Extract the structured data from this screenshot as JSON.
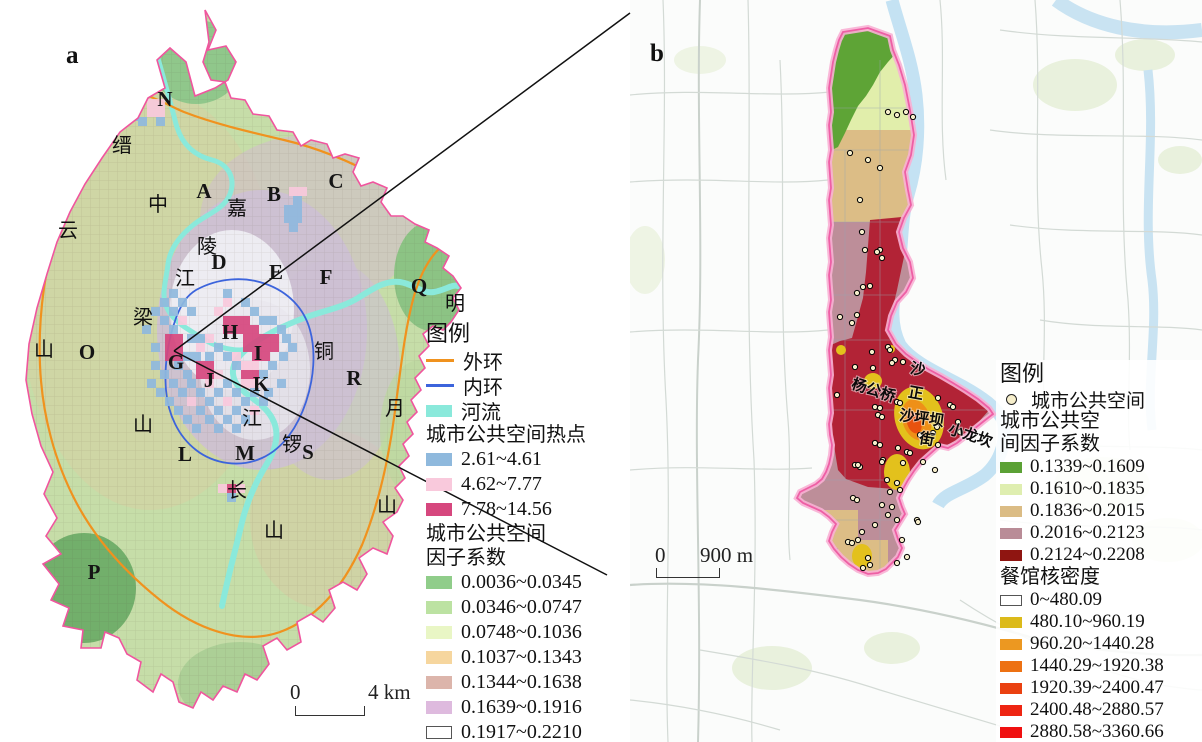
{
  "panel_a": {
    "label": "a",
    "scalebar": {
      "start": "0",
      "end": "4 km"
    },
    "letters": [
      {
        "t": "N",
        "x": 165,
        "y": 106
      },
      {
        "t": "A",
        "x": 204,
        "y": 198
      },
      {
        "t": "B",
        "x": 274,
        "y": 201
      },
      {
        "t": "C",
        "x": 336,
        "y": 188
      },
      {
        "t": "D",
        "x": 219,
        "y": 269
      },
      {
        "t": "E",
        "x": 276,
        "y": 279
      },
      {
        "t": "F",
        "x": 326,
        "y": 284
      },
      {
        "t": "Q",
        "x": 419,
        "y": 293
      },
      {
        "t": "G",
        "x": 176,
        "y": 369
      },
      {
        "t": "H",
        "x": 230,
        "y": 339
      },
      {
        "t": "I",
        "x": 258,
        "y": 360
      },
      {
        "t": "J",
        "x": 209,
        "y": 387
      },
      {
        "t": "K",
        "x": 261,
        "y": 391
      },
      {
        "t": "L",
        "x": 185,
        "y": 461
      },
      {
        "t": "M",
        "x": 245,
        "y": 460
      },
      {
        "t": "R",
        "x": 354,
        "y": 385
      },
      {
        "t": "S",
        "x": 308,
        "y": 459
      },
      {
        "t": "O",
        "x": 87,
        "y": 359
      },
      {
        "t": "P",
        "x": 94,
        "y": 579
      }
    ],
    "geo_labels": [
      {
        "t": "缙",
        "x": 122,
        "y": 152
      },
      {
        "t": "云",
        "x": 68,
        "y": 237
      },
      {
        "t": "山",
        "x": 44,
        "y": 356
      },
      {
        "t": "中",
        "x": 158,
        "y": 211
      },
      {
        "t": "梁",
        "x": 143,
        "y": 324
      },
      {
        "t": "山",
        "x": 143,
        "y": 431
      },
      {
        "t": "嘉",
        "x": 237,
        "y": 215
      },
      {
        "t": "陵",
        "x": 207,
        "y": 253
      },
      {
        "t": "江",
        "x": 185,
        "y": 285
      },
      {
        "t": "铜",
        "x": 324,
        "y": 358
      },
      {
        "t": "锣",
        "x": 292,
        "y": 451
      },
      {
        "t": "山",
        "x": 274,
        "y": 537
      },
      {
        "t": "明",
        "x": 455,
        "y": 310
      },
      {
        "t": "月",
        "x": 395,
        "y": 415
      },
      {
        "t": "山",
        "x": 387,
        "y": 512
      },
      {
        "t": "江",
        "x": 252,
        "y": 425
      },
      {
        "t": "长",
        "x": 237,
        "y": 497
      }
    ],
    "hotspot_cells": [
      [
        "p",
        147,
        99
      ],
      [
        "p",
        156,
        99
      ],
      [
        "p",
        147,
        108
      ],
      [
        "p",
        156,
        108
      ],
      [
        "b",
        129,
        112
      ],
      [
        "b",
        138,
        117
      ],
      [
        "b",
        156,
        117
      ],
      [
        "p",
        289,
        187
      ],
      [
        "p",
        298,
        187
      ],
      [
        "b",
        293,
        196
      ],
      [
        "b",
        284,
        205
      ],
      [
        "b",
        293,
        205
      ],
      [
        "b",
        284,
        214
      ],
      [
        "b",
        293,
        214
      ],
      [
        "b",
        289,
        223
      ],
      [
        "b",
        169,
        289
      ],
      [
        "b",
        223,
        289
      ],
      [
        "b",
        160,
        298
      ],
      [
        "b",
        178,
        298
      ],
      [
        "p",
        223,
        298
      ],
      [
        "b",
        241,
        298
      ],
      [
        "b",
        151,
        307
      ],
      [
        "b",
        169,
        307
      ],
      [
        "b",
        187,
        307
      ],
      [
        "p",
        214,
        307
      ],
      [
        "b",
        250,
        307
      ],
      [
        "b",
        160,
        316
      ],
      [
        "p",
        178,
        316
      ],
      [
        "m",
        223,
        316
      ],
      [
        "m",
        232,
        316
      ],
      [
        "m",
        241,
        316
      ],
      [
        "b",
        259,
        316
      ],
      [
        "b",
        268,
        316
      ],
      [
        "b",
        142,
        325
      ],
      [
        "b",
        169,
        325
      ],
      [
        "m",
        223,
        325
      ],
      [
        "m",
        232,
        325
      ],
      [
        "m",
        241,
        325
      ],
      [
        "m",
        250,
        325
      ],
      [
        "b",
        277,
        325
      ],
      [
        "m",
        165,
        334
      ],
      [
        "m",
        174,
        334
      ],
      [
        "b",
        187,
        334
      ],
      [
        "b",
        196,
        334
      ],
      [
        "p",
        205,
        334
      ],
      [
        "m",
        243,
        334
      ],
      [
        "m",
        252,
        334
      ],
      [
        "m",
        261,
        334
      ],
      [
        "m",
        270,
        334
      ],
      [
        "b",
        282,
        334
      ],
      [
        "m",
        165,
        343
      ],
      [
        "m",
        174,
        343
      ],
      [
        "b",
        151,
        343
      ],
      [
        "p",
        196,
        343
      ],
      [
        "b",
        214,
        343
      ],
      [
        "m",
        243,
        343
      ],
      [
        "m",
        252,
        343
      ],
      [
        "m",
        261,
        343
      ],
      [
        "m",
        270,
        343
      ],
      [
        "b",
        288,
        343
      ],
      [
        "m",
        165,
        352
      ],
      [
        "m",
        174,
        352
      ],
      [
        "b",
        183,
        352
      ],
      [
        "b",
        192,
        352
      ],
      [
        "b",
        205,
        352
      ],
      [
        "b",
        223,
        352
      ],
      [
        "p",
        232,
        352
      ],
      [
        "m",
        252,
        352
      ],
      [
        "m",
        261,
        352
      ],
      [
        "b",
        279,
        352
      ],
      [
        "b",
        151,
        361
      ],
      [
        "b",
        174,
        361
      ],
      [
        "m",
        196,
        361
      ],
      [
        "m",
        205,
        361
      ],
      [
        "b",
        232,
        361
      ],
      [
        "p",
        241,
        361
      ],
      [
        "p",
        250,
        361
      ],
      [
        "b",
        268,
        361
      ],
      [
        "b",
        160,
        370
      ],
      [
        "b",
        183,
        370
      ],
      [
        "m",
        196,
        370
      ],
      [
        "m",
        205,
        370
      ],
      [
        "p",
        214,
        370
      ],
      [
        "m",
        241,
        370
      ],
      [
        "m",
        250,
        370
      ],
      [
        "b",
        259,
        370
      ],
      [
        "b",
        147,
        379
      ],
      [
        "b",
        169,
        379
      ],
      [
        "b",
        187,
        379
      ],
      [
        "p",
        205,
        379
      ],
      [
        "b",
        223,
        379
      ],
      [
        "p",
        241,
        379
      ],
      [
        "p",
        250,
        379
      ],
      [
        "b",
        277,
        379
      ],
      [
        "b",
        156,
        388
      ],
      [
        "b",
        178,
        388
      ],
      [
        "b",
        196,
        388
      ],
      [
        "b",
        214,
        388
      ],
      [
        "b",
        232,
        388
      ],
      [
        "b",
        250,
        388
      ],
      [
        "b",
        264,
        388
      ],
      [
        "b",
        165,
        397
      ],
      [
        "p",
        187,
        397
      ],
      [
        "b",
        205,
        397
      ],
      [
        "p",
        223,
        397
      ],
      [
        "b",
        241,
        397
      ],
      [
        "b",
        259,
        397
      ],
      [
        "b",
        174,
        406
      ],
      [
        "b",
        196,
        406
      ],
      [
        "b",
        214,
        406
      ],
      [
        "b",
        232,
        406
      ],
      [
        "p",
        250,
        406
      ],
      [
        "b",
        183,
        415
      ],
      [
        "b",
        205,
        415
      ],
      [
        "b",
        223,
        415
      ],
      [
        "b",
        241,
        415
      ],
      [
        "b",
        192,
        424
      ],
      [
        "b",
        214,
        424
      ],
      [
        "b",
        232,
        424
      ],
      [
        "p",
        218,
        484
      ],
      [
        "m",
        227,
        484
      ],
      [
        "p",
        236,
        484
      ],
      [
        "b",
        227,
        493
      ]
    ],
    "legend": {
      "title": "图例",
      "lines": [
        {
          "label": "外环",
          "color": "#f0921e",
          "type": "line"
        },
        {
          "label": "内环",
          "color": "#3c64dc",
          "type": "line"
        },
        {
          "label": "河流",
          "color": "#8ae9db",
          "type": "riv"
        }
      ],
      "hotspot_title": "城市公共空间热点",
      "hotspot": [
        {
          "label": "2.61~4.61",
          "color": "#8fb9dd"
        },
        {
          "label": "4.62~7.77",
          "color": "#f9c9dc"
        },
        {
          "label": "7.78~14.56",
          "color": "#d6477e"
        }
      ],
      "factor_title_1": "城市公共空间",
      "factor_title_2": "因子系数",
      "factor": [
        {
          "label": "0.0036~0.0345",
          "color": "#90cd8a"
        },
        {
          "label": "0.0346~0.0747",
          "color": "#bce2a2"
        },
        {
          "label": "0.0748~0.1036",
          "color": "#e9f6c5"
        },
        {
          "label": "0.1037~0.1343",
          "color": "#f6d69e"
        },
        {
          "label": "0.1344~0.1638",
          "color": "#dcb5ab"
        },
        {
          "label": "0.1639~0.1916",
          "color": "#debade"
        },
        {
          "label": "0.1917~0.2210",
          "color": "#ffffff",
          "border": true
        }
      ]
    }
  },
  "panel_b": {
    "label": "b",
    "scalebar": {
      "start": "0",
      "end": "900 m"
    },
    "place_labels": [
      {
        "t": "杨公桥",
        "x": 872,
        "y": 395,
        "r": 18
      },
      {
        "t": "沙",
        "x": 917,
        "y": 374,
        "r": 10
      },
      {
        "t": "正",
        "x": 915,
        "y": 398,
        "r": 10
      },
      {
        "t": "沙坪坝",
        "x": 921,
        "y": 423,
        "r": 8
      },
      {
        "t": "街",
        "x": 926,
        "y": 444,
        "r": 10
      },
      {
        "t": "小龙坎",
        "x": 969,
        "y": 440,
        "r": 18
      }
    ],
    "points": [
      [
        850,
        153
      ],
      [
        868,
        160
      ],
      [
        880,
        168
      ],
      [
        888,
        112
      ],
      [
        897,
        115
      ],
      [
        906,
        112
      ],
      [
        913,
        117
      ],
      [
        860,
        200
      ],
      [
        862,
        232
      ],
      [
        865,
        250
      ],
      [
        880,
        250
      ],
      [
        882,
        258
      ],
      [
        877,
        252
      ],
      [
        863,
        287
      ],
      [
        870,
        286
      ],
      [
        857,
        293
      ],
      [
        840,
        317
      ],
      [
        852,
        323
      ],
      [
        857,
        315
      ],
      [
        888,
        347
      ],
      [
        890,
        350
      ],
      [
        872,
        352
      ],
      [
        895,
        360
      ],
      [
        855,
        367
      ],
      [
        873,
        368
      ],
      [
        892,
        363
      ],
      [
        903,
        362
      ],
      [
        837,
        395
      ],
      [
        875,
        407
      ],
      [
        880,
        408
      ],
      [
        897,
        402
      ],
      [
        900,
        403
      ],
      [
        878,
        415
      ],
      [
        882,
        417
      ],
      [
        938,
        398
      ],
      [
        950,
        405
      ],
      [
        953,
        407
      ],
      [
        958,
        422
      ],
      [
        960,
        432
      ],
      [
        937,
        427
      ],
      [
        920,
        435
      ],
      [
        933,
        433
      ],
      [
        875,
        443
      ],
      [
        880,
        445
      ],
      [
        898,
        448
      ],
      [
        907,
        452
      ],
      [
        910,
        453
      ],
      [
        855,
        465
      ],
      [
        860,
        467
      ],
      [
        883,
        460
      ],
      [
        923,
        462
      ],
      [
        935,
        470
      ],
      [
        853,
        498
      ],
      [
        857,
        500
      ],
      [
        892,
        507
      ],
      [
        858,
        465
      ],
      [
        882,
        462
      ],
      [
        903,
        463
      ],
      [
        938,
        445
      ],
      [
        887,
        480
      ],
      [
        897,
        483
      ],
      [
        890,
        492
      ],
      [
        900,
        490
      ],
      [
        882,
        505
      ],
      [
        888,
        515
      ],
      [
        897,
        520
      ],
      [
        862,
        532
      ],
      [
        848,
        542
      ],
      [
        852,
        543
      ],
      [
        858,
        540
      ],
      [
        868,
        558
      ],
      [
        870,
        565
      ],
      [
        863,
        568
      ],
      [
        897,
        563
      ],
      [
        907,
        557
      ],
      [
        917,
        520
      ],
      [
        918,
        522
      ],
      [
        902,
        540
      ],
      [
        875,
        525
      ]
    ],
    "legend": {
      "title": "图例",
      "point_label": "城市公共空间",
      "factor_title_1": "城市公共空",
      "factor_title_2": "间因子系数",
      "factor": [
        {
          "label": "0.1339~0.1609",
          "color": "#5ba135"
        },
        {
          "label": "0.1610~0.1835",
          "color": "#dfeeb0"
        },
        {
          "label": "0.1836~0.2015",
          "color": "#dbbc85"
        },
        {
          "label": "0.2016~0.2123",
          "color": "#b98c97"
        },
        {
          "label": "0.2124~0.2208",
          "color": "#8f1511"
        }
      ],
      "kernel_title": "餐馆核密度",
      "kernel": [
        {
          "label": "0~480.09",
          "color": "#ffffff",
          "border": true
        },
        {
          "label": "480.10~960.19",
          "color": "#dcba1a"
        },
        {
          "label": "960.20~1440.28",
          "color": "#ec9821"
        },
        {
          "label": "1440.29~1920.38",
          "color": "#ed7113"
        },
        {
          "label": "1920.39~2400.47",
          "color": "#ea4111"
        },
        {
          "label": "2400.48~2880.57",
          "color": "#ee2512"
        },
        {
          "label": "2880.58~3360.66",
          "color": "#f01010"
        }
      ]
    }
  }
}
